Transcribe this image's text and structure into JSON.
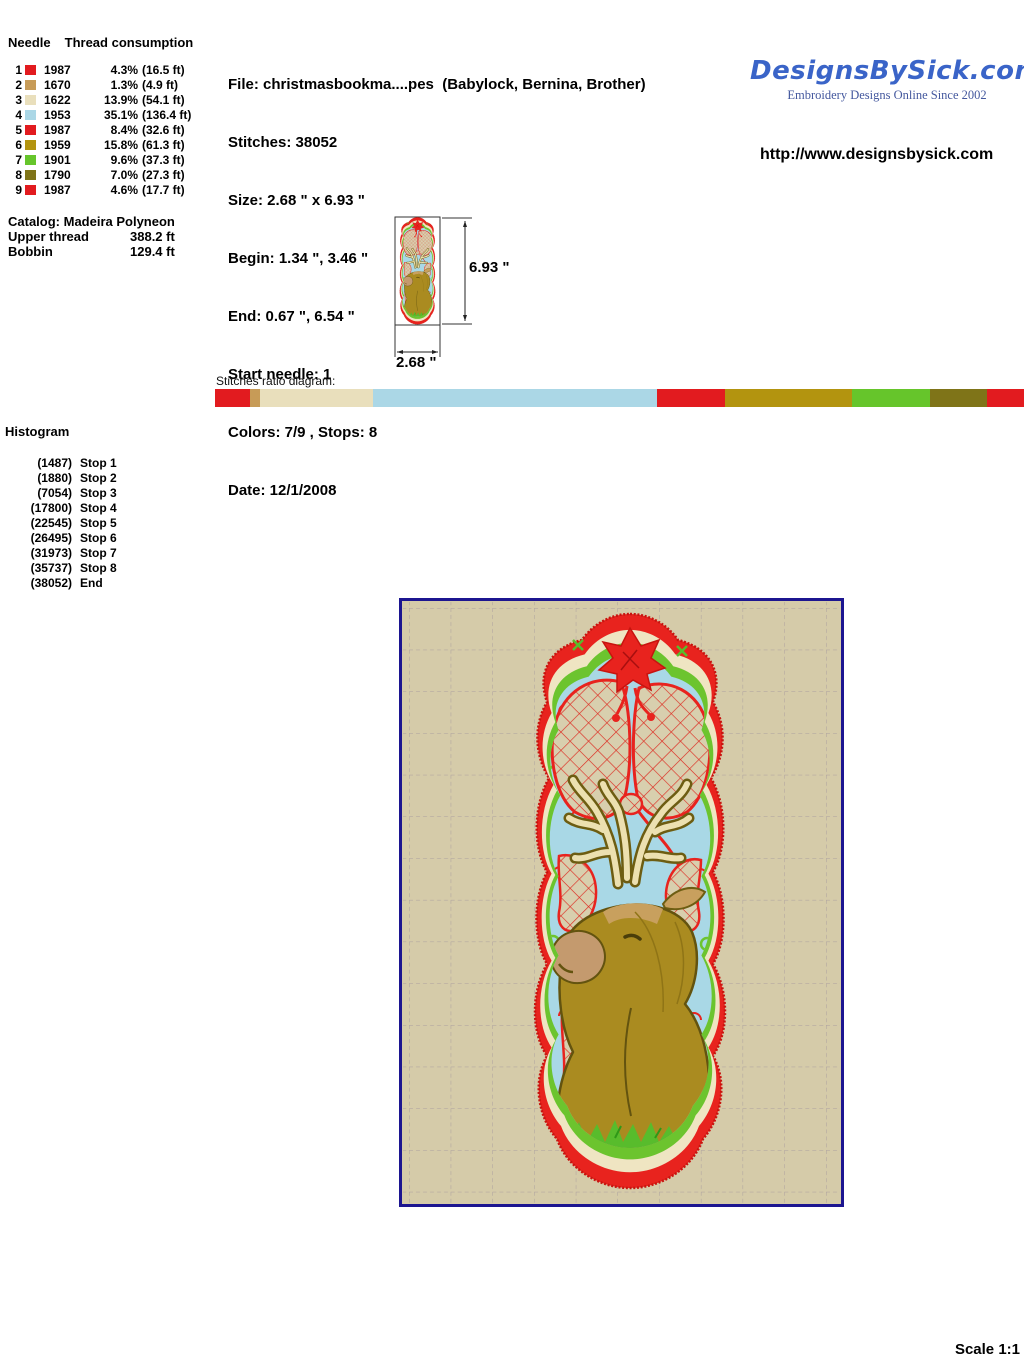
{
  "needle_table": {
    "col_needle": "Needle",
    "col_consumption": "Thread consumption",
    "rows": [
      {
        "needle": "1",
        "color": "#e21b1f",
        "thread": "1987",
        "pct": "4.3%",
        "feet": "(16.5 ft)"
      },
      {
        "needle": "2",
        "color": "#c79b57",
        "thread": "1670",
        "pct": "1.3%",
        "feet": "(4.9 ft)"
      },
      {
        "needle": "3",
        "color": "#e9dfbc",
        "thread": "1622",
        "pct": "13.9%",
        "feet": "(54.1 ft)"
      },
      {
        "needle": "4",
        "color": "#abd7e6",
        "thread": "1953",
        "pct": "35.1%",
        "feet": "(136.4 ft)"
      },
      {
        "needle": "5",
        "color": "#e21b1f",
        "thread": "1987",
        "pct": "8.4%",
        "feet": "(32.6 ft)"
      },
      {
        "needle": "6",
        "color": "#b3940f",
        "thread": "1959",
        "pct": "15.8%",
        "feet": "(61.3 ft)"
      },
      {
        "needle": "7",
        "color": "#66c52b",
        "thread": "1901",
        "pct": "9.6%",
        "feet": "(37.3 ft)"
      },
      {
        "needle": "8",
        "color": "#7f7418",
        "thread": "1790",
        "pct": "7.0%",
        "feet": "(27.3 ft)"
      },
      {
        "needle": "9",
        "color": "#e21b1f",
        "thread": "1987",
        "pct": "4.6%",
        "feet": "(17.7 ft)"
      }
    ]
  },
  "file_info": {
    "file": "File: christmasbookma....pes  (Babylock, Bernina, Brother)",
    "stitches": "Stitches: 38052",
    "size": "Size: 2.68 \" x 6.93 \"",
    "begin": "Begin: 1.34 \", 3.46 \"",
    "end": "End: 0.67 \", 6.54 \"",
    "start_needle": "Start needle: 1",
    "colors": "Colors: 7/9 , Stops: 8",
    "date": "Date: 12/1/2008"
  },
  "brand": {
    "logo": "DesignsBySick.com",
    "tagline": "Embroidery Designs Online Since 2002",
    "url": "http://www.designsbysick.com",
    "logo_color": "#3a64c8",
    "tagline_color": "#44589e"
  },
  "catalog": {
    "title": "Catalog: Madeira Polyneon",
    "upper_label": "Upper thread",
    "upper_value": "388.2 ft",
    "bobbin_label": "Bobbin",
    "bobbin_value": "129.4 ft"
  },
  "thumbnail": {
    "height_label": "6.93 \"",
    "width_label": "2.68 \""
  },
  "ratio": {
    "label": "Stitches ratio diagram:",
    "segments": [
      {
        "color": "#e21b1f",
        "pct": 4.3
      },
      {
        "color": "#c79b57",
        "pct": 1.3
      },
      {
        "color": "#e9dfbc",
        "pct": 13.9
      },
      {
        "color": "#abd7e6",
        "pct": 35.1
      },
      {
        "color": "#e21b1f",
        "pct": 8.4
      },
      {
        "color": "#b3940f",
        "pct": 15.8
      },
      {
        "color": "#66c52b",
        "pct": 9.6
      },
      {
        "color": "#7f7418",
        "pct": 7.0
      },
      {
        "color": "#e21b1f",
        "pct": 4.6
      }
    ]
  },
  "histogram": {
    "title": "Histogram",
    "entries": [
      {
        "count": "(1487)",
        "label": "Stop 1"
      },
      {
        "count": "(1880)",
        "label": "Stop 2"
      },
      {
        "count": "(7054)",
        "label": "Stop 3"
      },
      {
        "count": "(17800)",
        "label": "Stop 4"
      },
      {
        "count": "(22545)",
        "label": "Stop 5"
      },
      {
        "count": "(26495)",
        "label": "Stop 6"
      },
      {
        "count": "(31973)",
        "label": "Stop 7"
      },
      {
        "count": "(35737)",
        "label": "Stop 8"
      },
      {
        "count": "(38052)",
        "label": "End"
      }
    ]
  },
  "scale_label": "Scale 1:1"
}
